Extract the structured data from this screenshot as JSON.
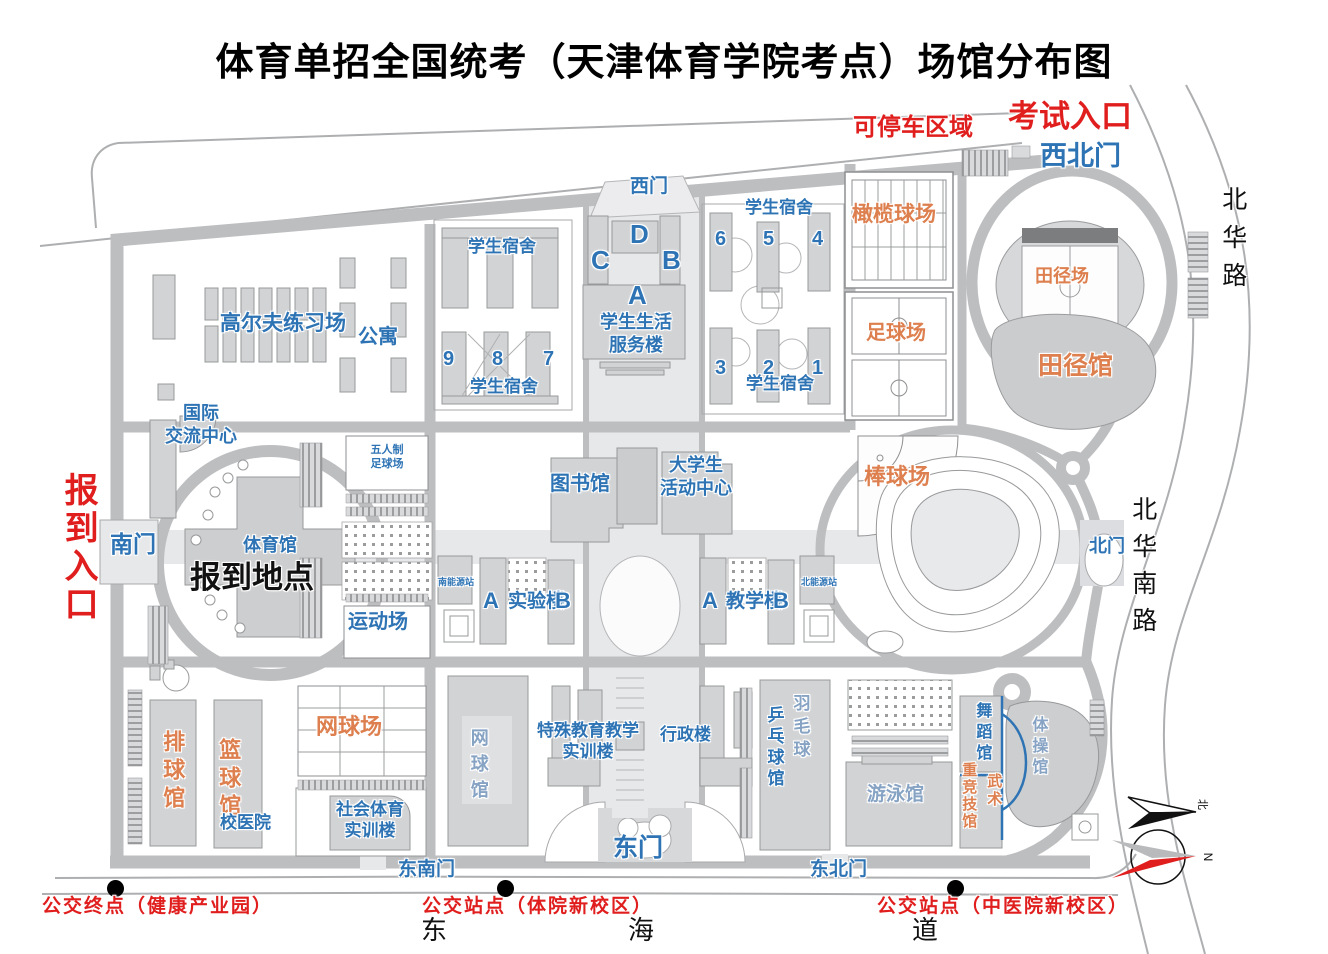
{
  "title": "体育单招全国统考（天津体育学院考点）场馆分布图",
  "annotations": {
    "parking_zone": "可停车区域",
    "exam_entrance": "考试入口",
    "checkin_entrance": "报到入口",
    "checkin_location": "报到地点"
  },
  "gates": {
    "northwest": "西北门",
    "west": "西门",
    "south": "南门",
    "north": "北门",
    "east": "东门",
    "southeast": "东南门",
    "northeast": "东北门"
  },
  "streets": {
    "beihua_road": "北华路",
    "beihua_south_road": "北华南路",
    "donghai_dong": "东",
    "donghai_hai": "海",
    "donghai_dao": "道"
  },
  "sports_venues": {
    "golf": "高尔夫练习场",
    "rugby_field": "橄榄球场",
    "soccer_field": "足球场",
    "track_field": "田径场",
    "track_hall": "田径馆",
    "baseball_field": "棒球场",
    "futsal_field": "五人制\n足球场",
    "sports_ground": "运动场",
    "gymnasium": "体育馆",
    "tennis_courts": "网球场",
    "volleyball_hall": "排球馆",
    "basketball_hall": "篮球馆",
    "tennis_hall": "网球馆",
    "table_tennis_hall": "乒乓球馆",
    "badminton": "羽毛球",
    "swimming_hall": "游泳馆",
    "dance_hall": "舞蹈馆",
    "gymnastics_hall": "体操馆",
    "heavy_athletics_hall": "重竞技馆",
    "wushu": "武术"
  },
  "buildings": {
    "apartment": "公寓",
    "intl_center": "国际\n交流中心",
    "dorm": "学生宿舍",
    "service_center": "学生生活\n服务楼",
    "library": "图书馆",
    "student_activity": "大学生\n活动中心",
    "south_energy": "南能源站",
    "north_energy": "北能源站",
    "lab": "实验楼",
    "teaching": "教学楼",
    "clinic": "校医院",
    "social_sports": "社会体育\n实训楼",
    "special_edu": "特殊教育教学\n实训楼",
    "admin": "行政楼"
  },
  "units": {
    "a": "A",
    "b": "B",
    "c": "C",
    "d": "D",
    "n1": "1",
    "n2": "2",
    "n3": "3",
    "n4": "4",
    "n5": "5",
    "n6": "6",
    "n7": "7",
    "n8": "8",
    "n9": "9"
  },
  "bus_stops": {
    "terminal": "公交终点（健康产业园）",
    "stop_tiyuan": "公交站点（体院新校区）",
    "stop_zhongyi": "公交站点（中医院新校区）"
  },
  "compass": {
    "north_char": "北",
    "n": "N"
  },
  "legend_colors": {
    "venue_label": "#dd7f4e",
    "building_label": "#2e74b5",
    "entrance_label": "#e01e1e",
    "road": "#bdbec0"
  }
}
